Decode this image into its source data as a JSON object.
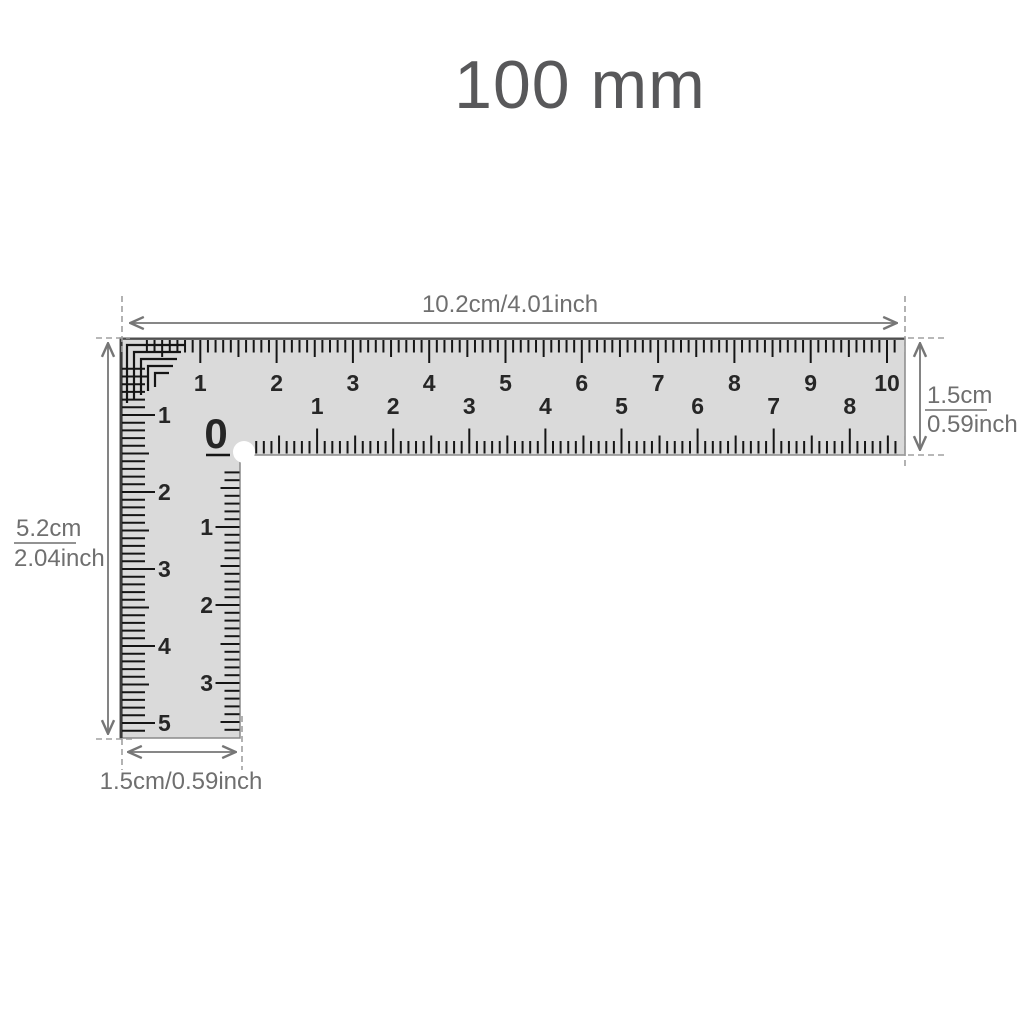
{
  "title": "100 mm",
  "annotations": {
    "top_length": "10.2cm/4.01inch",
    "right_width_cm": "1.5cm",
    "right_width_inch": "0.59inch",
    "left_height_cm": "5.2cm",
    "left_height_inch": "2.04inch",
    "bottom_width": "1.5cm/0.59inch"
  },
  "ruler": {
    "top_scale_numbers": [
      "1",
      "2",
      "3",
      "4",
      "5",
      "6",
      "7",
      "8",
      "9",
      "10"
    ],
    "inner_horizontal_zero": "0",
    "inner_horizontal_numbers": [
      "1",
      "2",
      "3",
      "4",
      "5",
      "6",
      "7",
      "8"
    ],
    "left_scale_numbers": [
      "1",
      "2",
      "3",
      "4",
      "5"
    ],
    "inner_vertical_numbers": [
      "1",
      "2",
      "3"
    ]
  },
  "colors": {
    "background": "#ffffff",
    "ruler_fill": "#dadada",
    "ruler_outline": "#8a8a8a",
    "ruler_dark_edge": "#3a3a3a",
    "tick": "#151515",
    "number": "#262626",
    "dimension": "#767676",
    "dashed": "#a0a0a0",
    "title": "#58585a"
  }
}
